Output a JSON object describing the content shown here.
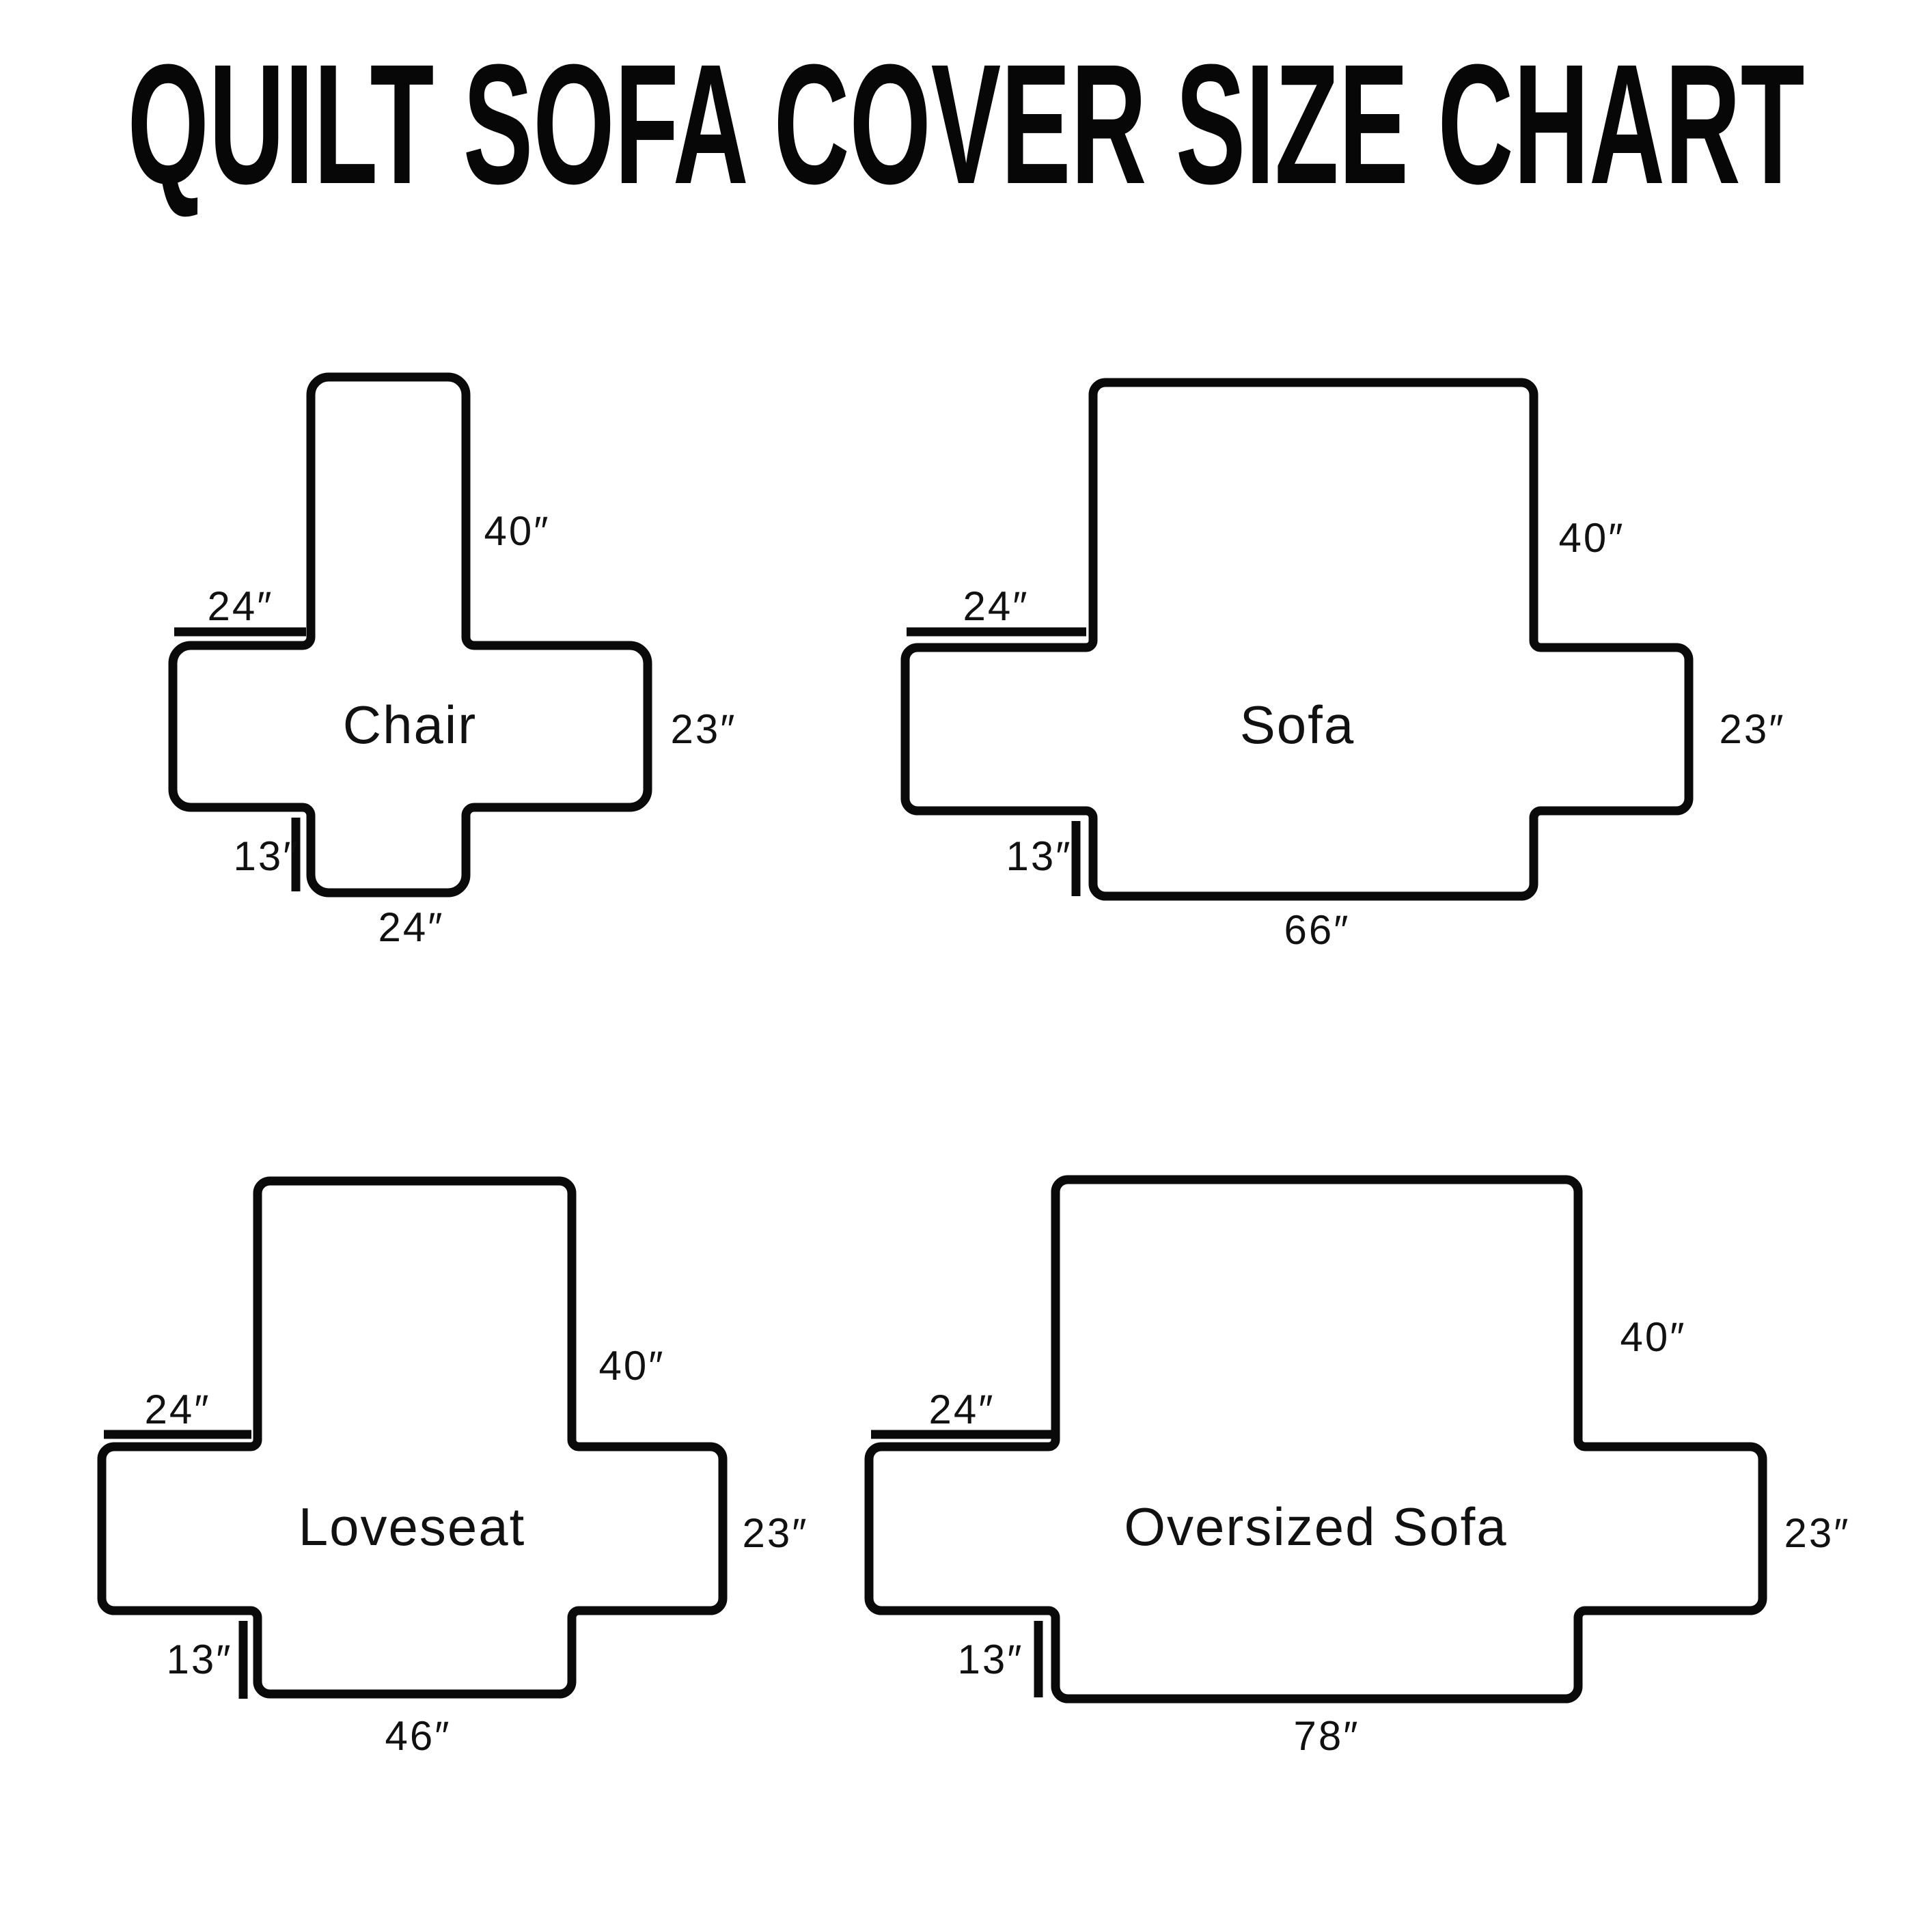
{
  "title": "QUILT SOFA COVER SIZE CHART",
  "diagrams": [
    {
      "id": "chair",
      "label": "Chair",
      "measurements": {
        "back_height": "40″",
        "arm_top_width": "24″",
        "arm_side_height": "23″",
        "skirt_height": "13″",
        "bottom_width": "24″"
      }
    },
    {
      "id": "sofa",
      "label": "Sofa",
      "measurements": {
        "back_height": "40″",
        "arm_top_width": "24″",
        "arm_side_height": "23″",
        "skirt_height": "13″",
        "bottom_width": "66″"
      }
    },
    {
      "id": "loveseat",
      "label": "Loveseat",
      "measurements": {
        "back_height": "40″",
        "arm_top_width": "24″",
        "arm_side_height": "23″",
        "skirt_height": "13″",
        "bottom_width": "46″"
      }
    },
    {
      "id": "oversized-sofa",
      "label": "Oversized Sofa",
      "measurements": {
        "back_height": "40″",
        "arm_top_width": "24″",
        "arm_side_height": "23″",
        "skirt_height": "13″",
        "bottom_width": "78″"
      }
    }
  ]
}
